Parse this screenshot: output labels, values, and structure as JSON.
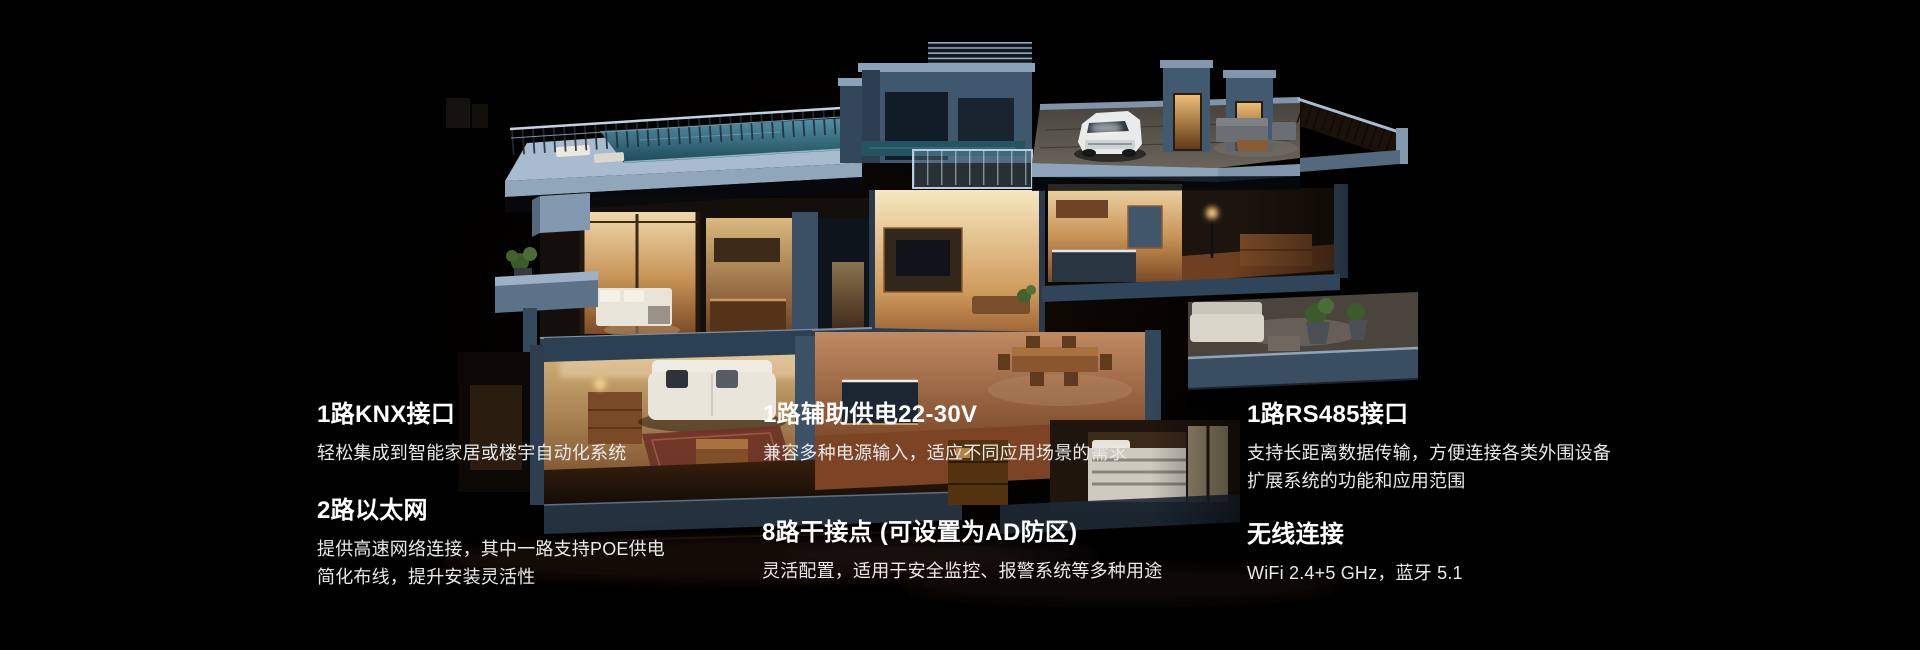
{
  "page": {
    "background": "#000000"
  },
  "palette": {
    "heading_color": "#ffffff",
    "body_color": "#e9e9e9",
    "wall_blue": "#5c7288",
    "wall_blue_light": "#9db1c6",
    "pool_teal": "#3e7a8e",
    "warm_interior": "#e9c789"
  },
  "illustration": {
    "type": "isometric-night-house-cutaway"
  },
  "features": {
    "columns": [
      {
        "items": [
          {
            "title": "1路KNX接口",
            "lines": [
              "轻松集成到智能家居或楼宇自动化系统"
            ]
          },
          {
            "title": "2路以太网",
            "lines": [
              "提供高速网络连接，其中一路支持POE供电",
              "简化布线，提升安装灵活性"
            ]
          }
        ]
      },
      {
        "items": [
          {
            "title": "1路辅助供电22-30V",
            "lines": [
              "兼容多种电源输入，适应不同应用场景的需求"
            ]
          },
          {
            "title": "8路干接点 (可设置为AD防区)",
            "lines": [
              "灵活配置，适用于安全监控、报警系统等多种用途"
            ]
          }
        ]
      },
      {
        "items": [
          {
            "title": "1路RS485接口",
            "lines": [
              "支持长距离数据传输，方便连接各类外围设备",
              "扩展系统的功能和应用范围"
            ]
          },
          {
            "title": "无线连接",
            "lines": [
              "WiFi 2.4+5 GHz，蓝牙 5.1"
            ]
          }
        ]
      }
    ]
  }
}
